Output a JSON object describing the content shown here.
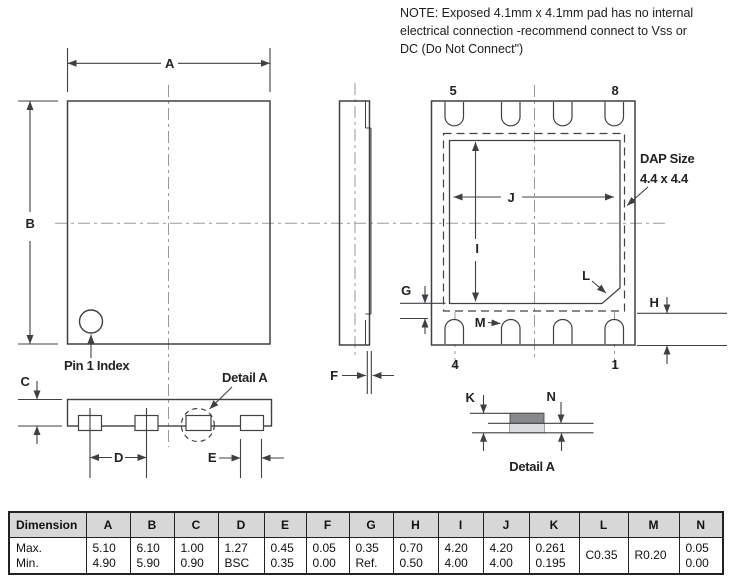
{
  "note": {
    "line1": "NOTE:  Exposed 4.1mm x 4.1mm pad has no internal",
    "line2": "electrical connection -recommend connect to Vss or",
    "line3": "DC (Do Not Connect\")"
  },
  "labels": {
    "dim_a": "A",
    "dim_b": "B",
    "dim_c": "C",
    "dim_d": "D",
    "dim_e": "E",
    "dim_f": "F",
    "dim_g": "G",
    "dim_h": "H",
    "dim_i": "I",
    "dim_j": "J",
    "dim_k": "K",
    "dim_l": "L",
    "dim_m": "M",
    "dim_n": "N",
    "pin1_index": "Pin 1 Index",
    "detail_a_pointer": "Detail A",
    "detail_a_caption": "Detail A",
    "dap_size_line1": "DAP Size",
    "dap_size_line2": "4.4 x 4.4",
    "pin5": "5",
    "pin8": "8",
    "pin4": "4",
    "pin1": "1"
  },
  "table": {
    "headers": [
      "Dimension",
      "A",
      "B",
      "C",
      "D",
      "E",
      "F",
      "G",
      "H",
      "I",
      "J",
      "K",
      "L",
      "M",
      "N"
    ],
    "row_labels": [
      "Max.",
      "Min."
    ],
    "cells": [
      {
        "max": "5.10",
        "min": "4.90"
      },
      {
        "max": "6.10",
        "min": "5.90"
      },
      {
        "max": "1.00",
        "min": "0.90"
      },
      {
        "max": "1.27",
        "min": "BSC"
      },
      {
        "max": "0.45",
        "min": "0.35"
      },
      {
        "max": "0.05",
        "min": "0.00"
      },
      {
        "max": "0.35",
        "min": "Ref."
      },
      {
        "max": "0.70",
        "min": "0.50"
      },
      {
        "max": "4.20",
        "min": "4.00"
      },
      {
        "max": "4.20",
        "min": "4.00"
      },
      {
        "max": "0.261",
        "min": "0.195"
      },
      {
        "single": "C0.35"
      },
      {
        "single": "R0.20"
      },
      {
        "max": "0.05",
        "min": "0.00"
      }
    ]
  },
  "colors": {
    "line": "#3f4043",
    "centerline": "#9a9a9a",
    "pad_dark": "#87898c",
    "pad_light": "#dadbdc",
    "table_header_bg": "#d7d7d7"
  }
}
